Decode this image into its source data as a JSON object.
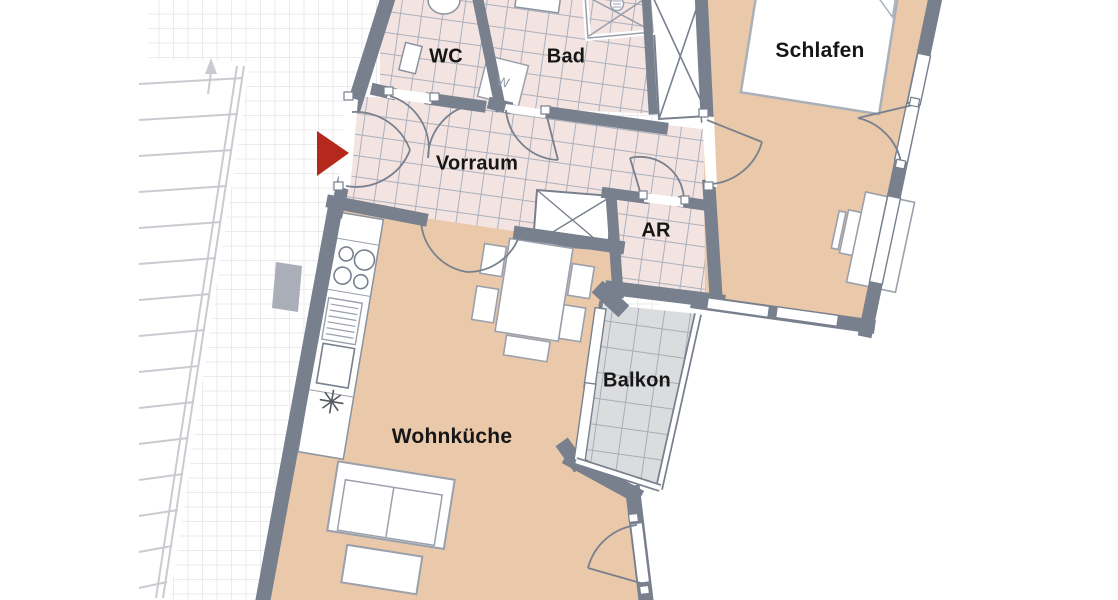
{
  "rooms": [
    {
      "id": "wc",
      "label": "WC"
    },
    {
      "id": "bad",
      "label": "Bad"
    },
    {
      "id": "schlafen",
      "label": "Schlafen"
    },
    {
      "id": "vorraum",
      "label": "Vorraum"
    },
    {
      "id": "abstellraum",
      "label": "AR"
    },
    {
      "id": "balkon",
      "label": "Balkon"
    },
    {
      "id": "wohnkueche",
      "label": "Wohnküche"
    }
  ],
  "appliances": {
    "washing_machine_label": "W"
  },
  "markers": {
    "entrance_arrow_color": "#b5291c"
  },
  "colors": {
    "wall": "#78808e",
    "tile_floor": "#f3e4e1",
    "wood_floor": "#eac8aa",
    "balcony_floor": "#dbdcde",
    "background_grid": "#ebebee"
  }
}
